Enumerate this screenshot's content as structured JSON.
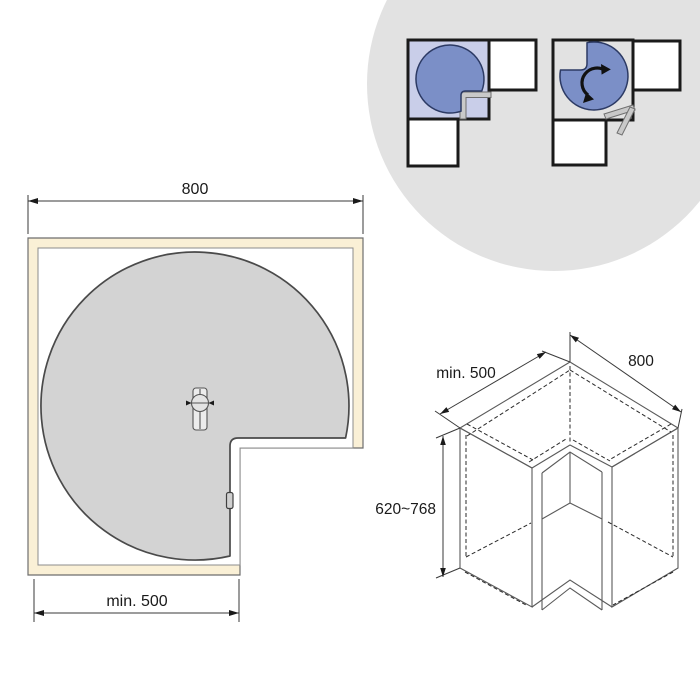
{
  "canvas": {
    "width": 700,
    "height": 700,
    "background": "#ffffff"
  },
  "colors": {
    "badge_circle": "#e2e2e2",
    "cabinet_cream": "#faf0d6",
    "tray_gray": "#d3d3d3",
    "tray_outline": "#4a4a4a",
    "pictogram_blue": "#7b8fc7",
    "pictogram_blue_outline": "#2c3a64",
    "pictogram_lavender": "#c9cee9",
    "door_gray": "#c9c9c9",
    "line_dark": "#1a1a1a"
  },
  "plan_view": {
    "name": "carousel-plan-view",
    "width_dim": "800",
    "depth_dim": "min. 500"
  },
  "iso_view": {
    "name": "cabinet-isometric-view",
    "depth_dim": "min. 500",
    "width_dim": "800",
    "height_dim": "620~768"
  },
  "badge": {
    "name": "usage-pictograms",
    "icons": [
      "corner-cabinet-carousel-closed-pictogram",
      "corner-cabinet-carousel-rotating-pictogram",
      "rotate-arrow-icon",
      "open-door-icon"
    ]
  }
}
